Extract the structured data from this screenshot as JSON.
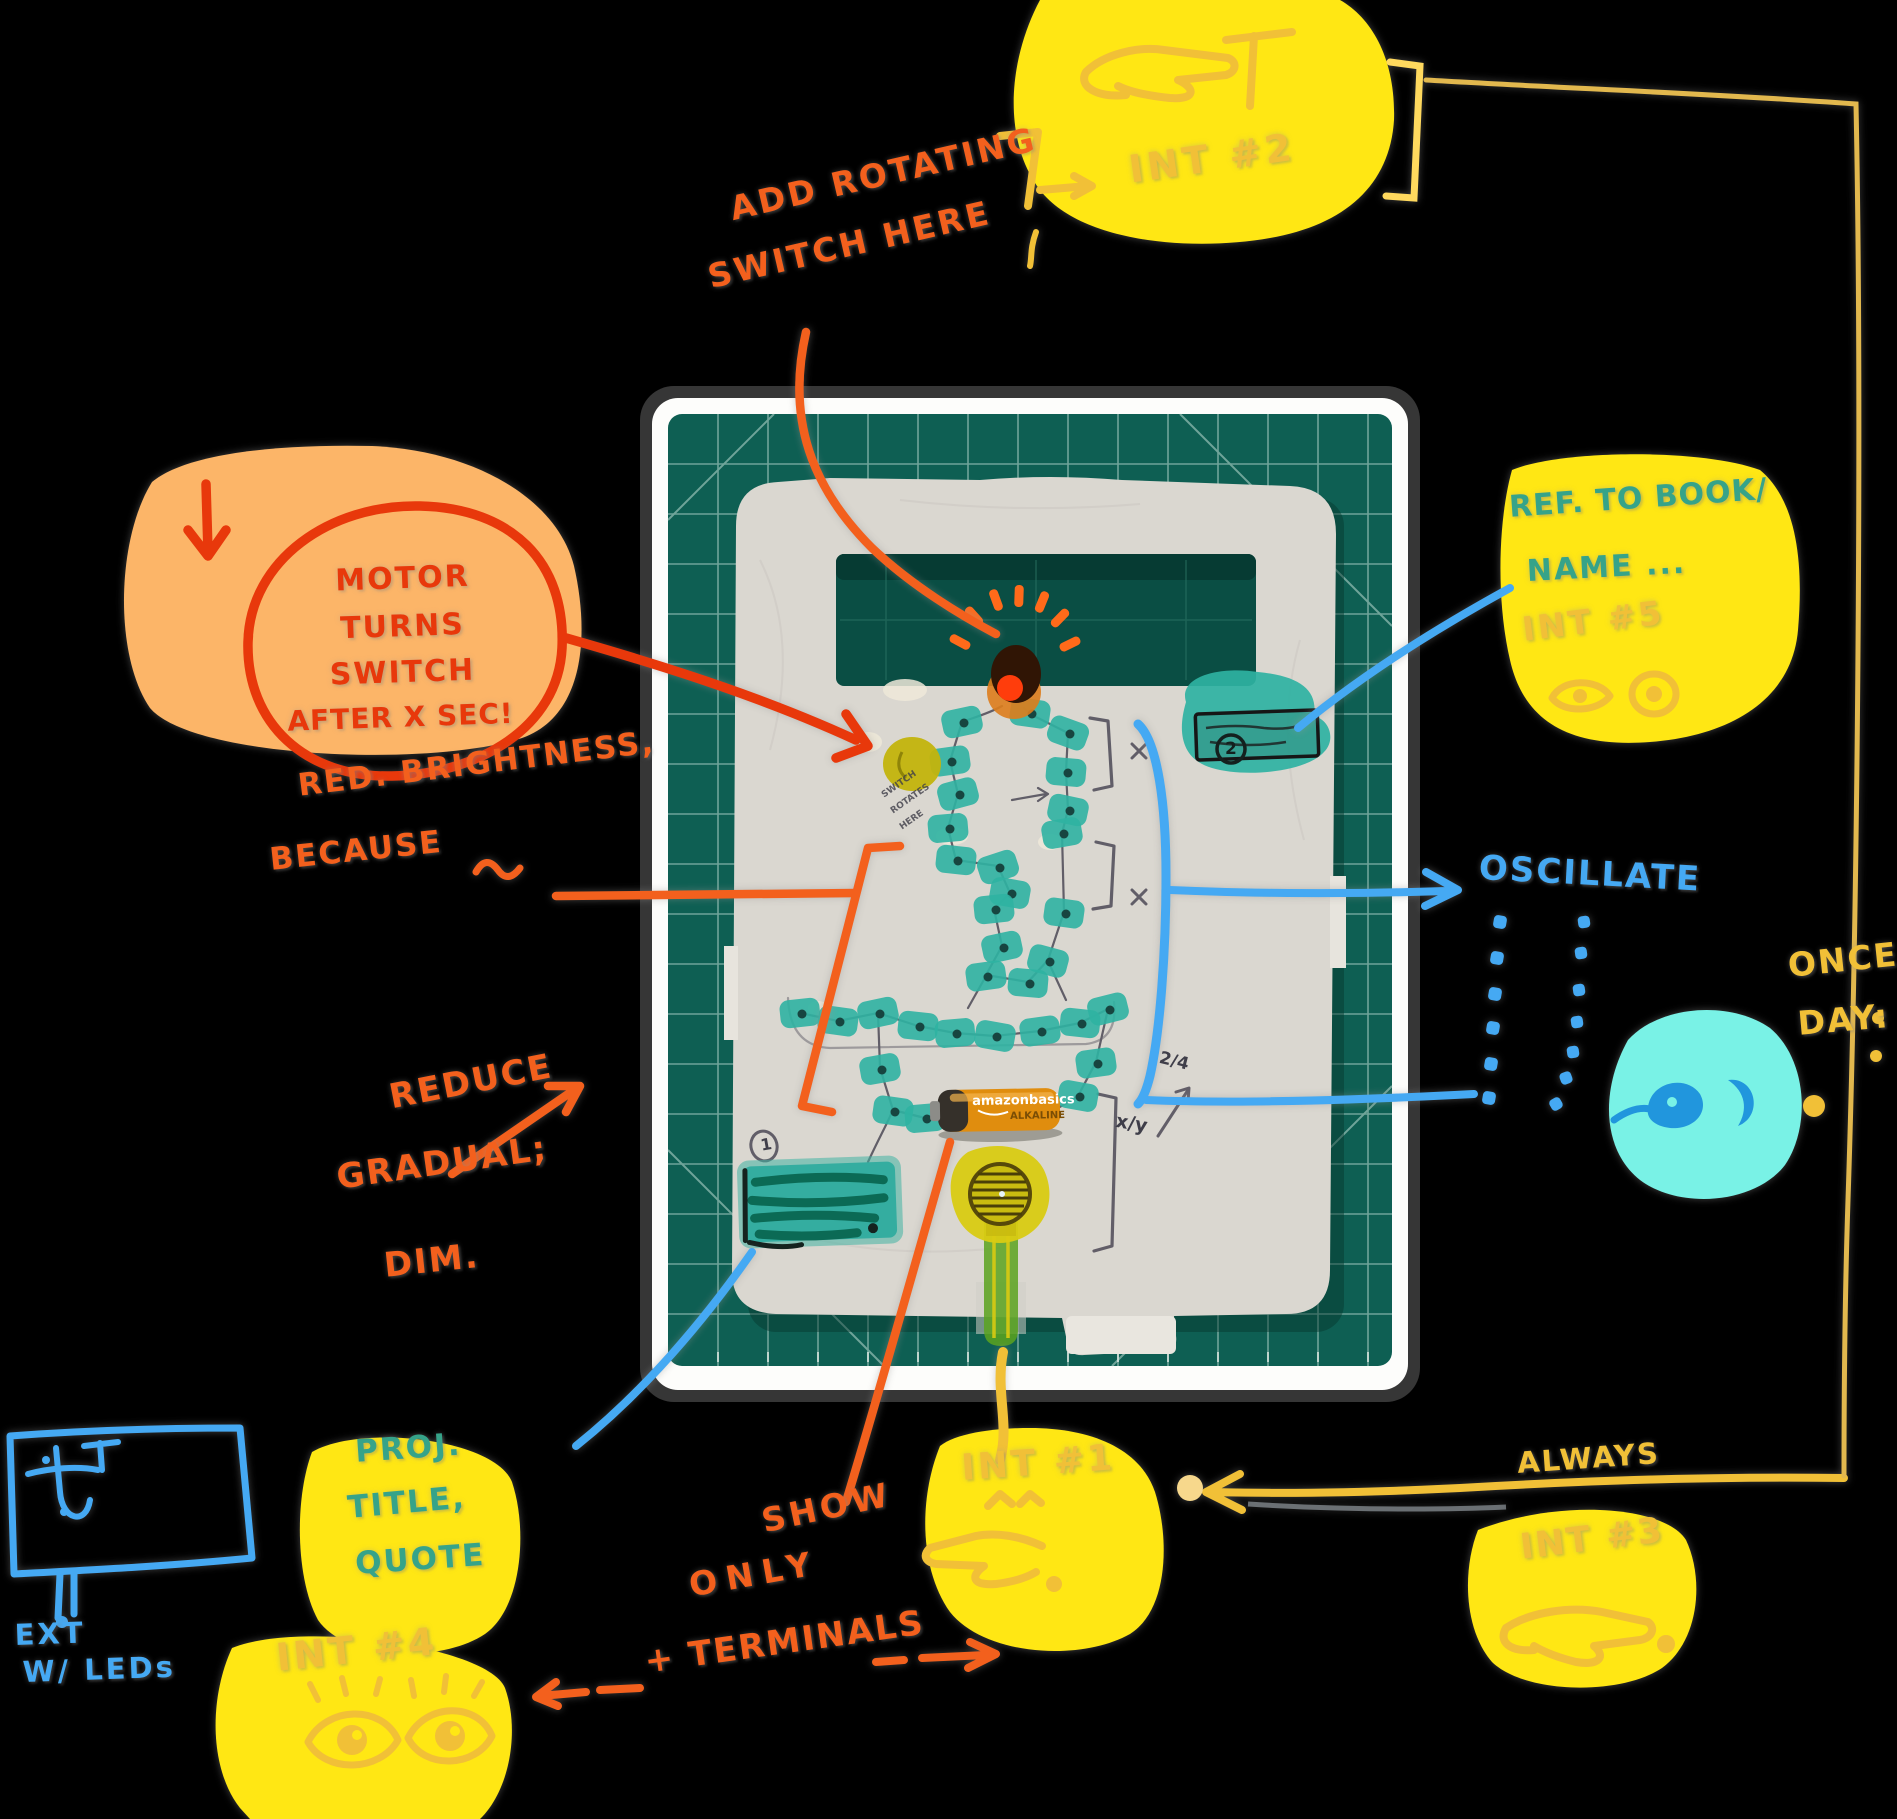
{
  "canvas": {
    "width": 1897,
    "height": 1819,
    "background": "#000000"
  },
  "colors": {
    "marker_orange": "#f3601d",
    "marker_red_orange": "#e8380b",
    "blob_orange": "#fcb568",
    "blob_yellow": "#ffe714",
    "doodle_mustard": "#f1c037",
    "edge_line_yellow": "#e2b84e",
    "marker_blue": "#45a9f3",
    "blob_cyan": "#79f2e6",
    "eye_blue": "#2196dd",
    "text_teal": "#36a389",
    "mat_green": "#0e5f53",
    "component_teal": "#2fb2a2",
    "battery_orange": "#e08d0e",
    "sensor_yellow": "#d9cb12"
  },
  "notes": {
    "rotating_switch": {
      "line1": "ADD ROTATING",
      "line2": "SWITCH HERE"
    },
    "int2": {
      "label": "INT #2"
    },
    "motor": {
      "line1": "MOTOR",
      "line2": "TURNS",
      "line3": "SWITCH",
      "line4": "AFTER X SEC!"
    },
    "brightness": {
      "line1": "RED. BRIGHTNESS,",
      "line2": "BECAUSE"
    },
    "reduce": {
      "line1": "REDUCE",
      "line2": "GRADUAL;",
      "line3": "DIM."
    },
    "show_terminals": {
      "word1": "SHOW",
      "word2": "ONLY",
      "word3": "+ TERMINALS"
    },
    "ref_book": {
      "line1": "REF. TO BOOK/",
      "line2": "NAME ...",
      "int_label": "INT #5"
    },
    "oscillate": {
      "label": "OSCILLATE"
    },
    "once_day": {
      "line1": "ONCE",
      "line2": "DAY:"
    },
    "always": {
      "label": "ALWAYS"
    },
    "int1": {
      "label": "INT #1"
    },
    "int3": {
      "label": "INT #3"
    },
    "project": {
      "line1": "PROJ.",
      "line2": "TITLE,",
      "line3": "QUOTE",
      "int_label": "INT #4"
    },
    "ext_leds": {
      "line1": "EXT",
      "line2": "W/ LEDs"
    }
  },
  "photo": {
    "battery": {
      "brand": "amazonbasics",
      "type": "ALKALINE"
    },
    "pencil": {
      "circled_one": "1",
      "circled_two": "2",
      "ratio_a": "2/4",
      "ratio_b": "x/y",
      "scribble": {
        "line1": "SWITCH",
        "line2": "ROTATES",
        "line3": "HERE"
      }
    },
    "led_stickers": [
      [
        962,
        722,
        -12
      ],
      [
        1030,
        713,
        8
      ],
      [
        1068,
        733,
        20
      ],
      [
        950,
        761,
        -8
      ],
      [
        1066,
        772,
        5
      ],
      [
        958,
        794,
        -15
      ],
      [
        1068,
        810,
        12
      ],
      [
        948,
        828,
        -5
      ],
      [
        1062,
        833,
        -10
      ],
      [
        956,
        860,
        6
      ],
      [
        998,
        867,
        -18
      ],
      [
        1010,
        893,
        10
      ],
      [
        994,
        909,
        -6
      ],
      [
        1064,
        913,
        8
      ],
      [
        1002,
        947,
        -12
      ],
      [
        1048,
        961,
        15
      ],
      [
        986,
        976,
        -8
      ],
      [
        1028,
        983,
        5
      ],
      [
        800,
        1013,
        -6
      ],
      [
        838,
        1021,
        8
      ],
      [
        878,
        1013,
        -12
      ],
      [
        918,
        1026,
        6
      ],
      [
        955,
        1033,
        -5
      ],
      [
        995,
        1036,
        10
      ],
      [
        1040,
        1031,
        -8
      ],
      [
        1080,
        1023,
        6
      ],
      [
        1108,
        1009,
        -14
      ],
      [
        880,
        1069,
        -10
      ],
      [
        893,
        1111,
        8
      ],
      [
        925,
        1118,
        -5
      ],
      [
        1078,
        1096,
        10
      ],
      [
        1096,
        1063,
        -8
      ]
    ]
  },
  "icons": {
    "pointing_hand": "☞",
    "eyes": "👁",
    "down_arrow": "↓",
    "right_arrow": "→",
    "left_arrow": "←",
    "sine_wave": "∿"
  }
}
